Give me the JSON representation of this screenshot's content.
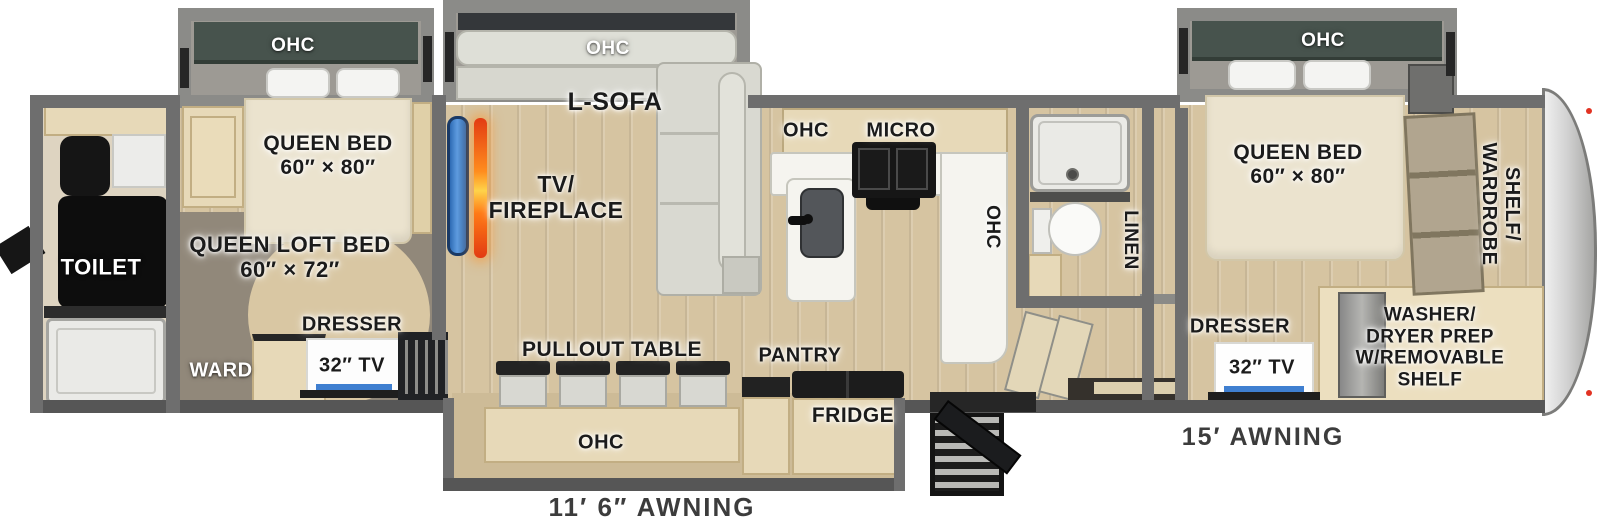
{
  "labels": {
    "rear_slide_ohc": "OHC",
    "rear_queen_bed": "QUEEN BED\n60″ × 80″",
    "toilet": "TOILET",
    "queen_loft_bed": "QUEEN LOFT BED\n60″ × 72″",
    "ward": "WARD",
    "rear_dresser": "DRESSER",
    "rear_tv": "32″ TV",
    "sofa_slide_ohc": "OHC",
    "l_sofa": "L-SOFA",
    "tv_fireplace": "TV/\nFIREPLACE",
    "kitchen_ohc": "OHC",
    "kitchen_micro": "MICRO",
    "kitchen_counter_ohc": "OHC",
    "pullout_table": "PULLOUT TABLE",
    "dinette_ohc": "OHC",
    "pantry": "PANTRY",
    "fridge": "FRIDGE",
    "linen": "LINEN",
    "front_slide_ohc": "OHC",
    "front_queen_bed": "QUEEN BED\n60″ × 80″",
    "shelf_wardrobe": "SHELF/\nWARDROBE",
    "front_dresser": "DRESSER",
    "front_tv": "32″ TV",
    "washer_dryer": "WASHER/\nDRYER PREP\nW/REMOVABLE\nSHELF",
    "awning_left": "11′ 6″ AWNING",
    "awning_right": "15′ AWNING"
  },
  "colors": {
    "wall": "#6e6e6e",
    "wall_dark": "#565656",
    "floor_wood": "#d6c4a1",
    "carpet": "#91887a",
    "cabinet_wood": "#e7d9b8",
    "ohc_cabinet_green": "#47534d",
    "bed": "#ebe3ce",
    "sofa": "#d9d9d1",
    "counter_white": "#f5f4ef",
    "tv_blue": "#4a8fd4",
    "flame_orange": "#ff8c1e",
    "appliance_black": "#1c1c1c",
    "front_cap_silver": "#d2d2d2"
  }
}
